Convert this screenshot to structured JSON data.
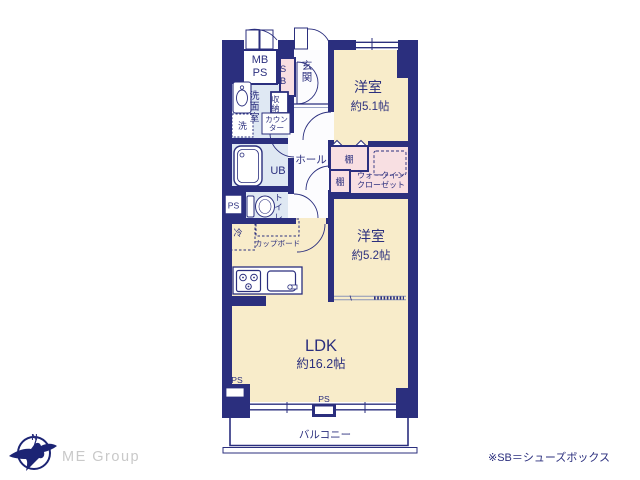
{
  "plan": {
    "rooms": {
      "bedroom1": {
        "label": "洋室",
        "size": "約5.1帖"
      },
      "bedroom2": {
        "label": "洋室",
        "size": "約5.2帖"
      },
      "ldk": {
        "label": "LDK",
        "size": "約16.2帖"
      },
      "entrance": "玄関",
      "hall": "ホール",
      "washroom": "洗面室",
      "unit_bath": "UB",
      "toilet": "トイレ",
      "wic_line1": "ウォークイン",
      "wic_line2": "クローゼット",
      "balcony": "バルコニー"
    },
    "fixtures": {
      "mb": "MB",
      "ps": "PS",
      "sb": "SB",
      "storage": "収納",
      "counter_line1": "カウン",
      "counter_line2": "ター",
      "washer": "洗",
      "fridge": "冷",
      "cupboard": "カップボード",
      "shelf": "棚"
    },
    "colors": {
      "wall": "#2b2f7e",
      "room_cream": "#f8ecca",
      "closet_pink": "#f8dfe2",
      "wet_blue": "#dfe8f3",
      "text": "#2b2f7e"
    }
  },
  "footer": {
    "brand": "ME Group",
    "compass_north": "N",
    "note": "※SB＝シューズボックス"
  }
}
